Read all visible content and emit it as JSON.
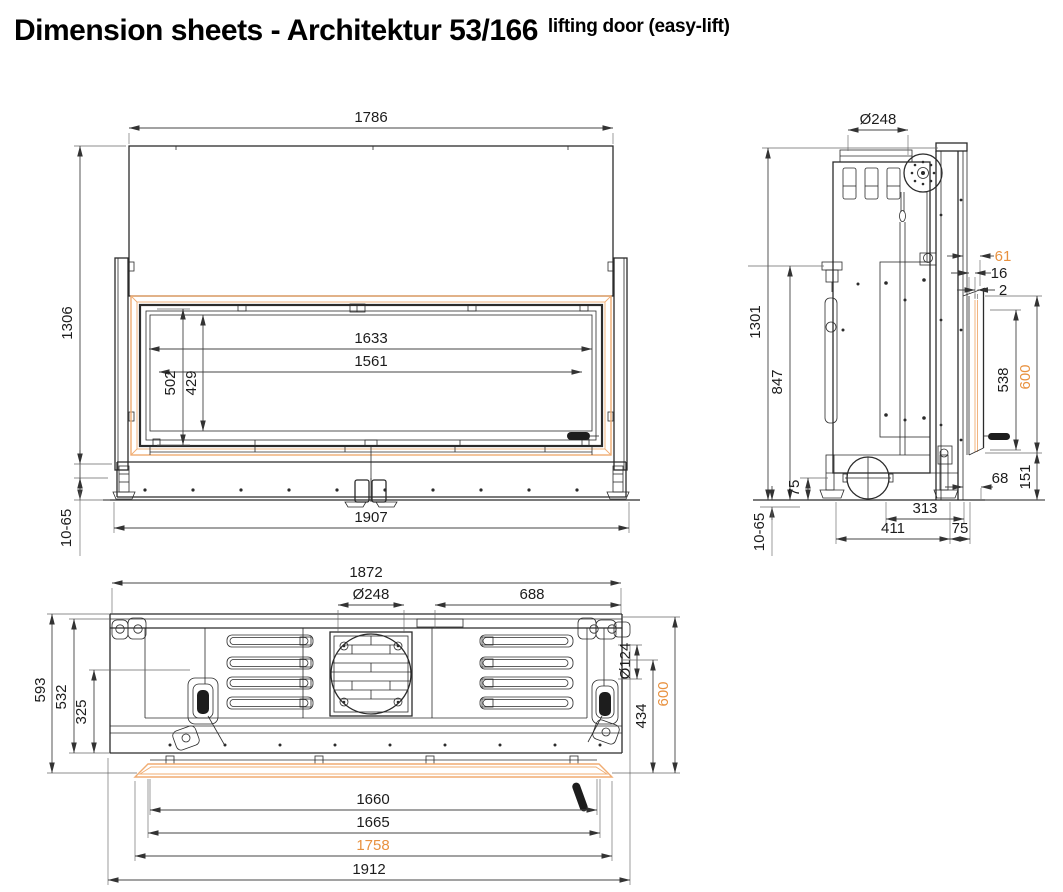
{
  "title": {
    "main": "Dimension sheets - Architektur 53/166",
    "suffix": "lifting door (easy-lift)"
  },
  "colors": {
    "accent_orange_text": "#E8913F",
    "frame_orange_line": "#F0AC72",
    "drawing_line": "#2b2b2b"
  },
  "views": {
    "front": {
      "label": "front-view",
      "dims": {
        "overall_width_top": "1786",
        "overall_height": "1306",
        "glass_width_outer": "1633",
        "glass_width_inner": "1561",
        "glass_height_outer": "502",
        "glass_height_inner": "429",
        "base_width": "1907",
        "foot_adjust_range": "10-65"
      }
    },
    "side": {
      "label": "side-view",
      "dims": {
        "flue_diameter": "Ø248",
        "front_offset_61": "61",
        "front_offset_16": "16",
        "front_offset_2": "2",
        "total_height": "1301",
        "anchor_height": "847",
        "glass_height": "538",
        "opening_height": "600",
        "foot_height_75": "75",
        "depth_68": "68",
        "height_151": "151",
        "depth_313": "313",
        "depth_411": "411",
        "depth_75": "75",
        "foot_adjust_range": "10-65"
      }
    },
    "top": {
      "label": "top-view",
      "dims": {
        "overall_width": "1872",
        "flue_diameter": "Ø248",
        "flue_to_side": "688",
        "depth_total": "593",
        "depth_532": "532",
        "depth_325": "325",
        "intake_diameter": "Ø124",
        "depth_434": "434",
        "depth_600": "600",
        "glass_width_1660": "1660",
        "glass_width_1665": "1665",
        "frame_width_1758": "1758",
        "overall_width_bottom": "1912"
      }
    }
  }
}
